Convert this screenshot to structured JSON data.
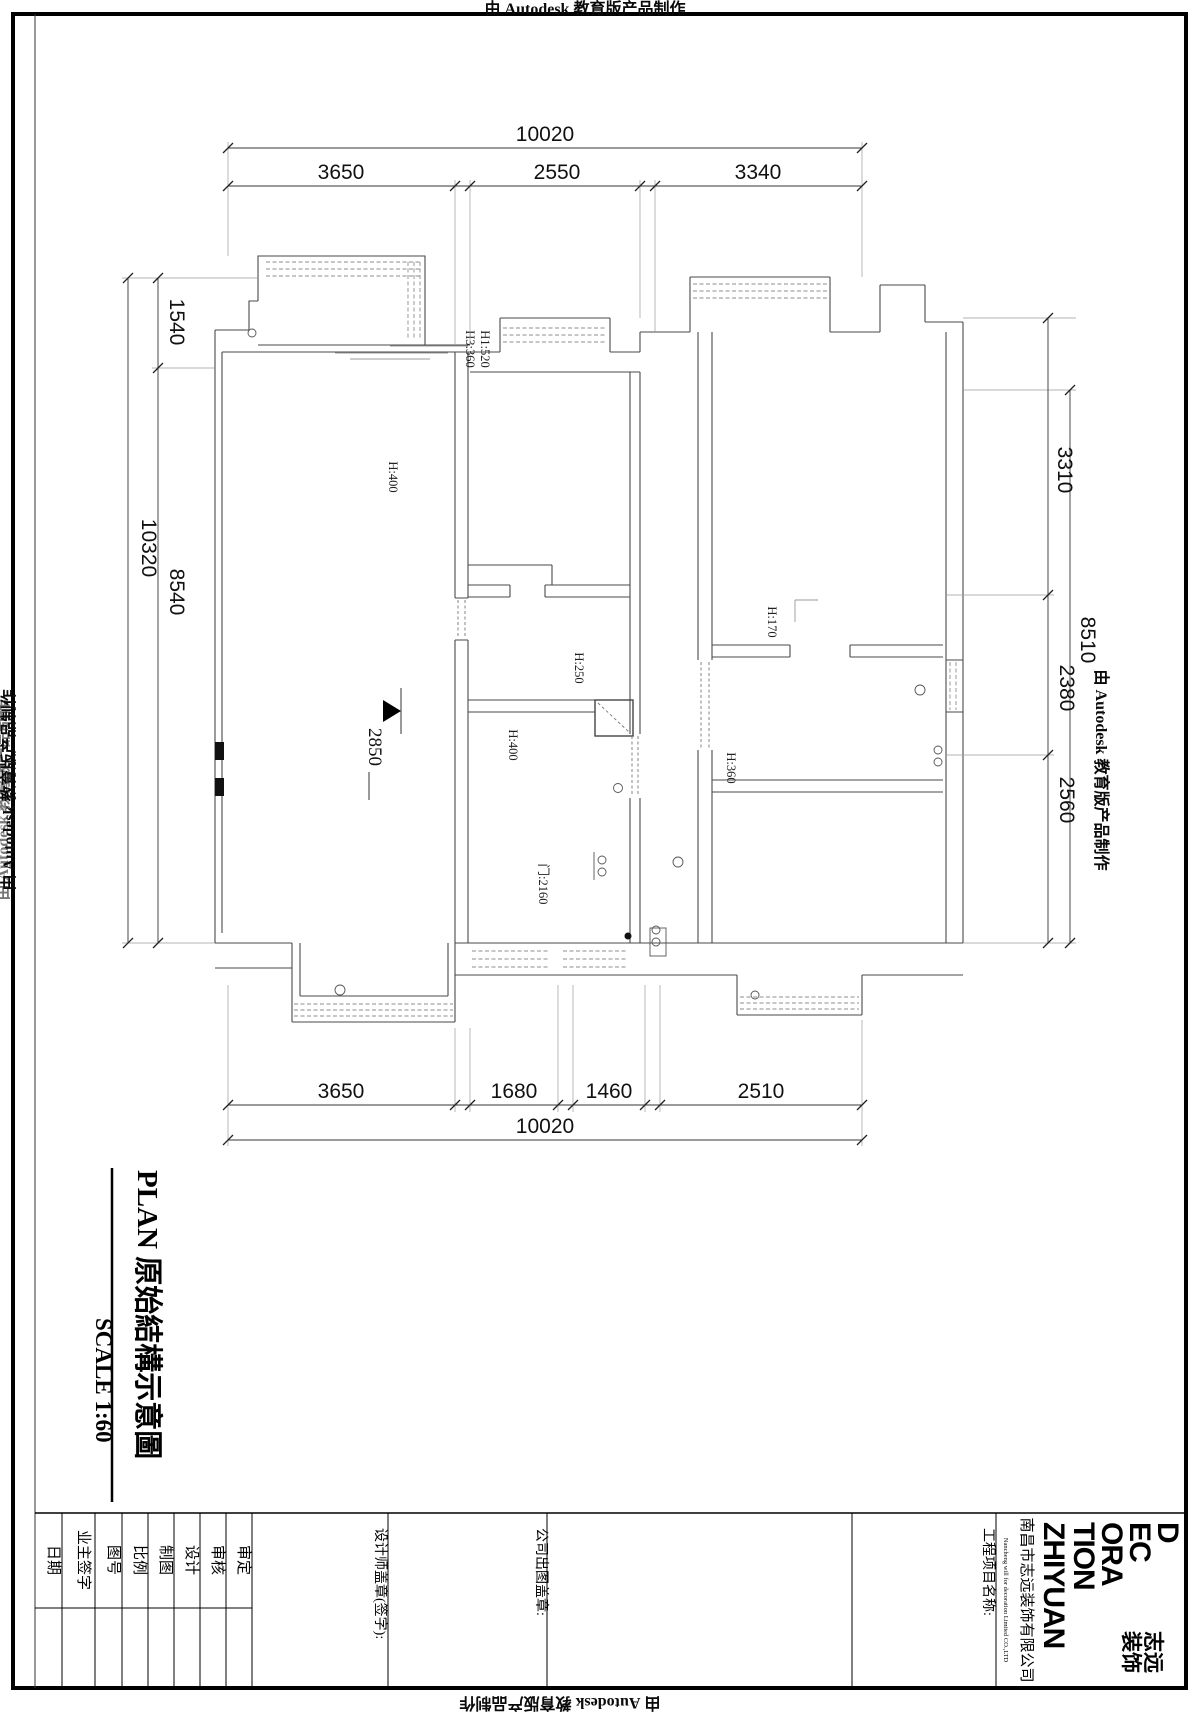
{
  "banner": {
    "autodesk": "由 Autodesk 教育版产品制作"
  },
  "dimensions": {
    "top": {
      "overall": "10020",
      "seg1": "3650",
      "seg2": "2550",
      "seg3": "3340"
    },
    "bottom": {
      "overall": "10020",
      "seg1": "3650",
      "seg2": "1680",
      "seg3": "1460",
      "seg4": "2510"
    },
    "left": {
      "overall": "10320",
      "seg1": "1540",
      "seg2": "8540"
    },
    "right": {
      "overall": "8510",
      "seg1": "3310",
      "seg2": "2380",
      "seg3": "2560"
    }
  },
  "plan": {
    "labels": {
      "bay_h3": "H3:360",
      "bay_h1": "H1:520",
      "living": "H:400",
      "closet": "H:250",
      "passage": "H:400",
      "bedroom": "H:170",
      "doorway": "H:360",
      "door": "门:2160",
      "ceiling_height": "2850"
    }
  },
  "title": {
    "name": "PLAN  原始結構示意圖",
    "scale": "SCALE  1:60"
  },
  "title_block": {
    "fields": {
      "date": "日期",
      "owner_sign": "业主签字",
      "drawing_no": "图号",
      "scale": "比例",
      "drafted": "制图",
      "designed": "设计",
      "reviewed": "审核",
      "approved": "审定"
    },
    "designer_stamp": "设计师盖章(签字):",
    "company_stamp": "公司出图盖章:",
    "project_name": "工程项目名称:",
    "company_cn": "南昌市志远装饰有限公司",
    "company_en": "Nancheng will for decoration Limited CO.,LTD",
    "logo": {
      "l1": "D",
      "l2": "EC",
      "l3": "ORA",
      "l4": "TION",
      "l5": "ZHIYUAN",
      "cn1": "志远",
      "cn2": "装饰"
    }
  }
}
